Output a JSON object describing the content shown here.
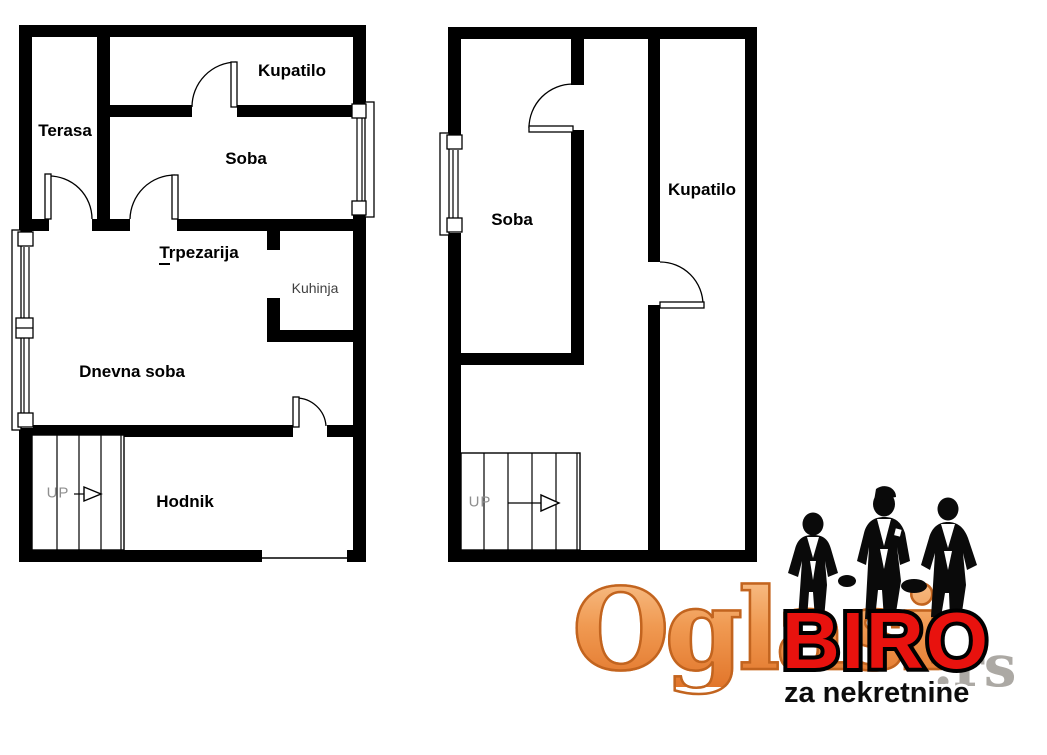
{
  "page": {
    "background": "#ffffff"
  },
  "plans": {
    "left": {
      "rooms": {
        "kupatilo": "Kupatilo",
        "terasa": "Terasa",
        "soba": "Soba",
        "trpezarija": "Trpezarija",
        "kuhinja": "Kuhinja",
        "dnevna_soba": "Dnevna soba",
        "hodnik": "Hodnik"
      },
      "stairs": {
        "label": "UP"
      }
    },
    "right": {
      "rooms": {
        "soba": "Soba",
        "kupatilo": "Kupatilo"
      },
      "stairs": {
        "label": "UP"
      }
    }
  },
  "watermark": {
    "brand": "Oglasi",
    "tld": ".rs",
    "agency": "BIRO",
    "tagline": "za nekretnine",
    "colors": {
      "brand_orange": "#f0944d",
      "brand_outline": "#c2641f",
      "agency_red": "#e8120e",
      "tagline_black": "#0d0d0d",
      "silhouette_black": "#0a0a0a"
    }
  },
  "drawing": {
    "wall_color": "#000000",
    "thin_line_color": "#000000",
    "muted_label_color": "#8f8f8f"
  }
}
